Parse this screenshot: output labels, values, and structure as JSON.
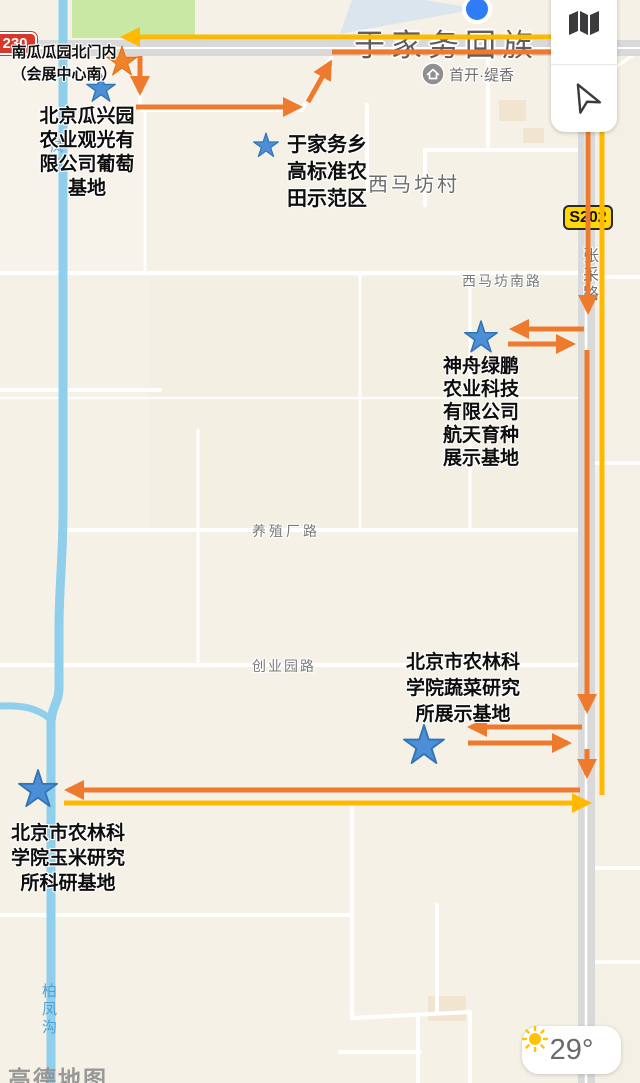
{
  "header": {
    "region_label": "于家务回族"
  },
  "map_labels": {
    "village": "西马坊村",
    "road_south": "西马坊南路",
    "road_breeding": "养殖厂路",
    "road_park": "创业园路",
    "road_vertical": "张采路",
    "river_lower": "柏凤沟",
    "river_upper": "凤沟",
    "poi_label": "首开·缇香",
    "watermark": "高德地图",
    "badge_g230": "230",
    "badge_s202": "S202"
  },
  "sites": [
    {
      "id": "pumpkin-garden-north-gate",
      "marker": "orange-star",
      "lines": [
        "南瓜瓜园北门内",
        "（会展中心南）"
      ]
    },
    {
      "id": "guaxingyuan-grape-base",
      "marker": "blue-star",
      "lines": [
        "北京瓜兴园",
        "农业观光有",
        "限公司葡萄",
        "基地"
      ]
    },
    {
      "id": "high-standard-farmland-demo",
      "marker": "blue-star",
      "lines": [
        "于家务乡",
        "高标准农",
        "田示范区"
      ]
    },
    {
      "id": "shenzhou-lvpeng-space-breeding-base",
      "marker": "blue-star",
      "lines": [
        "神舟绿鹏",
        "农业科技",
        "有限公司",
        "航天育种",
        "展示基地"
      ]
    },
    {
      "id": "vegetable-research-demo-base",
      "marker": "blue-star",
      "lines": [
        "北京市农林科",
        "学院蔬菜研究",
        "所展示基地"
      ]
    },
    {
      "id": "corn-research-base",
      "marker": "blue-star",
      "lines": [
        "北京市农林科",
        "学院玉米研究",
        "所科研基地"
      ]
    }
  ],
  "weather": {
    "temperature": "29°"
  },
  "colors": {
    "route_orange": "#EE7B2D",
    "route_yellow": "#FFB900",
    "star_blue": "#4D8FD6",
    "star_blue_stroke": "#3273B4",
    "star_orange": "#F08228",
    "star_orange_stroke": "#DD6E12",
    "badge_red": "#D6392C",
    "badge_yellow": "#FFD60A",
    "river_blue": "#8FCFEC",
    "road_gray": "#D9D9D9",
    "bg_beige": "#F5F1E6",
    "green_area": "#C9E8A3"
  }
}
